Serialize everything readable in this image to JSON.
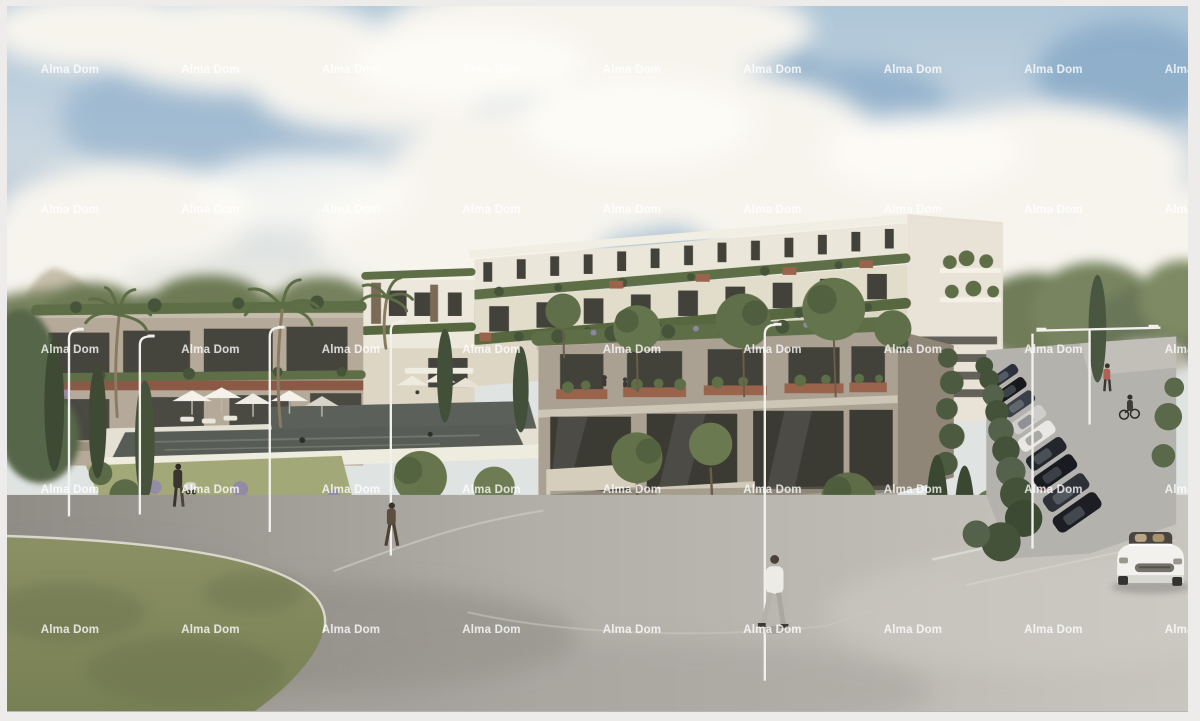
{
  "image": {
    "kind": "architectural rendering photo",
    "subject": "modern terraced apartment complex with rooftop gardens, pool deck, parking row, curving road, pedestrians and a white convertible"
  },
  "watermark": {
    "text": "Alma Dom",
    "color": "#ffffff",
    "opacity": 0.78,
    "font_size_px": 11.5,
    "grid": {
      "columns": 9,
      "rows": 5,
      "start_x": 70,
      "start_y": 70,
      "step_x": 140.5,
      "step_y": 140
    }
  },
  "palette": {
    "frame": "#edecea",
    "sky_top": "#aec6d8",
    "sky_mid": "#c9d6e0",
    "horizon": "#e8e8e2",
    "cloud": "#f7f4ee",
    "cloud_bright": "#fdfbf6",
    "blue_patch": "#85a7c6",
    "treeline": "#77825d",
    "facade_light": "#eae6d9",
    "facade_cream": "#e2dccb",
    "facade_taupe": "#aaa192",
    "facade_taupe_dark": "#8f8678",
    "left_facade": "#b5aa99",
    "window_dark": "#42413a",
    "glass_dark": "#3b3a33",
    "plant": "#5e6e47",
    "plant_dark": "#46553a",
    "terracotta": "#9a644c",
    "pool_water": "#575d56",
    "deck": "#e4e0d4",
    "stone": "#d6cebc",
    "garden_grass": "#9aa172",
    "grass": "#8c9165",
    "road_mid": "#b2afa8",
    "parking": "#b4b2ad",
    "hedge": "#44523a",
    "lamp": "#f1f0ec",
    "car_white": "#f2f1ed"
  },
  "scene": {
    "elements": [
      "sky with cumulus clouds",
      "distant treeline and hill",
      "long white apartment block with planted terraces",
      "left taupe residential wing",
      "near taupe wing with glass ground floor",
      "stepped pool deck with umbrellas and loungers",
      "mediterranean garden with olive trees and cypresses",
      "parking row with cars and hedge",
      "curving asphalt road",
      "grass verge",
      "white convertible car",
      "pedestrians, stroller and cyclist",
      "white street lamps"
    ]
  }
}
